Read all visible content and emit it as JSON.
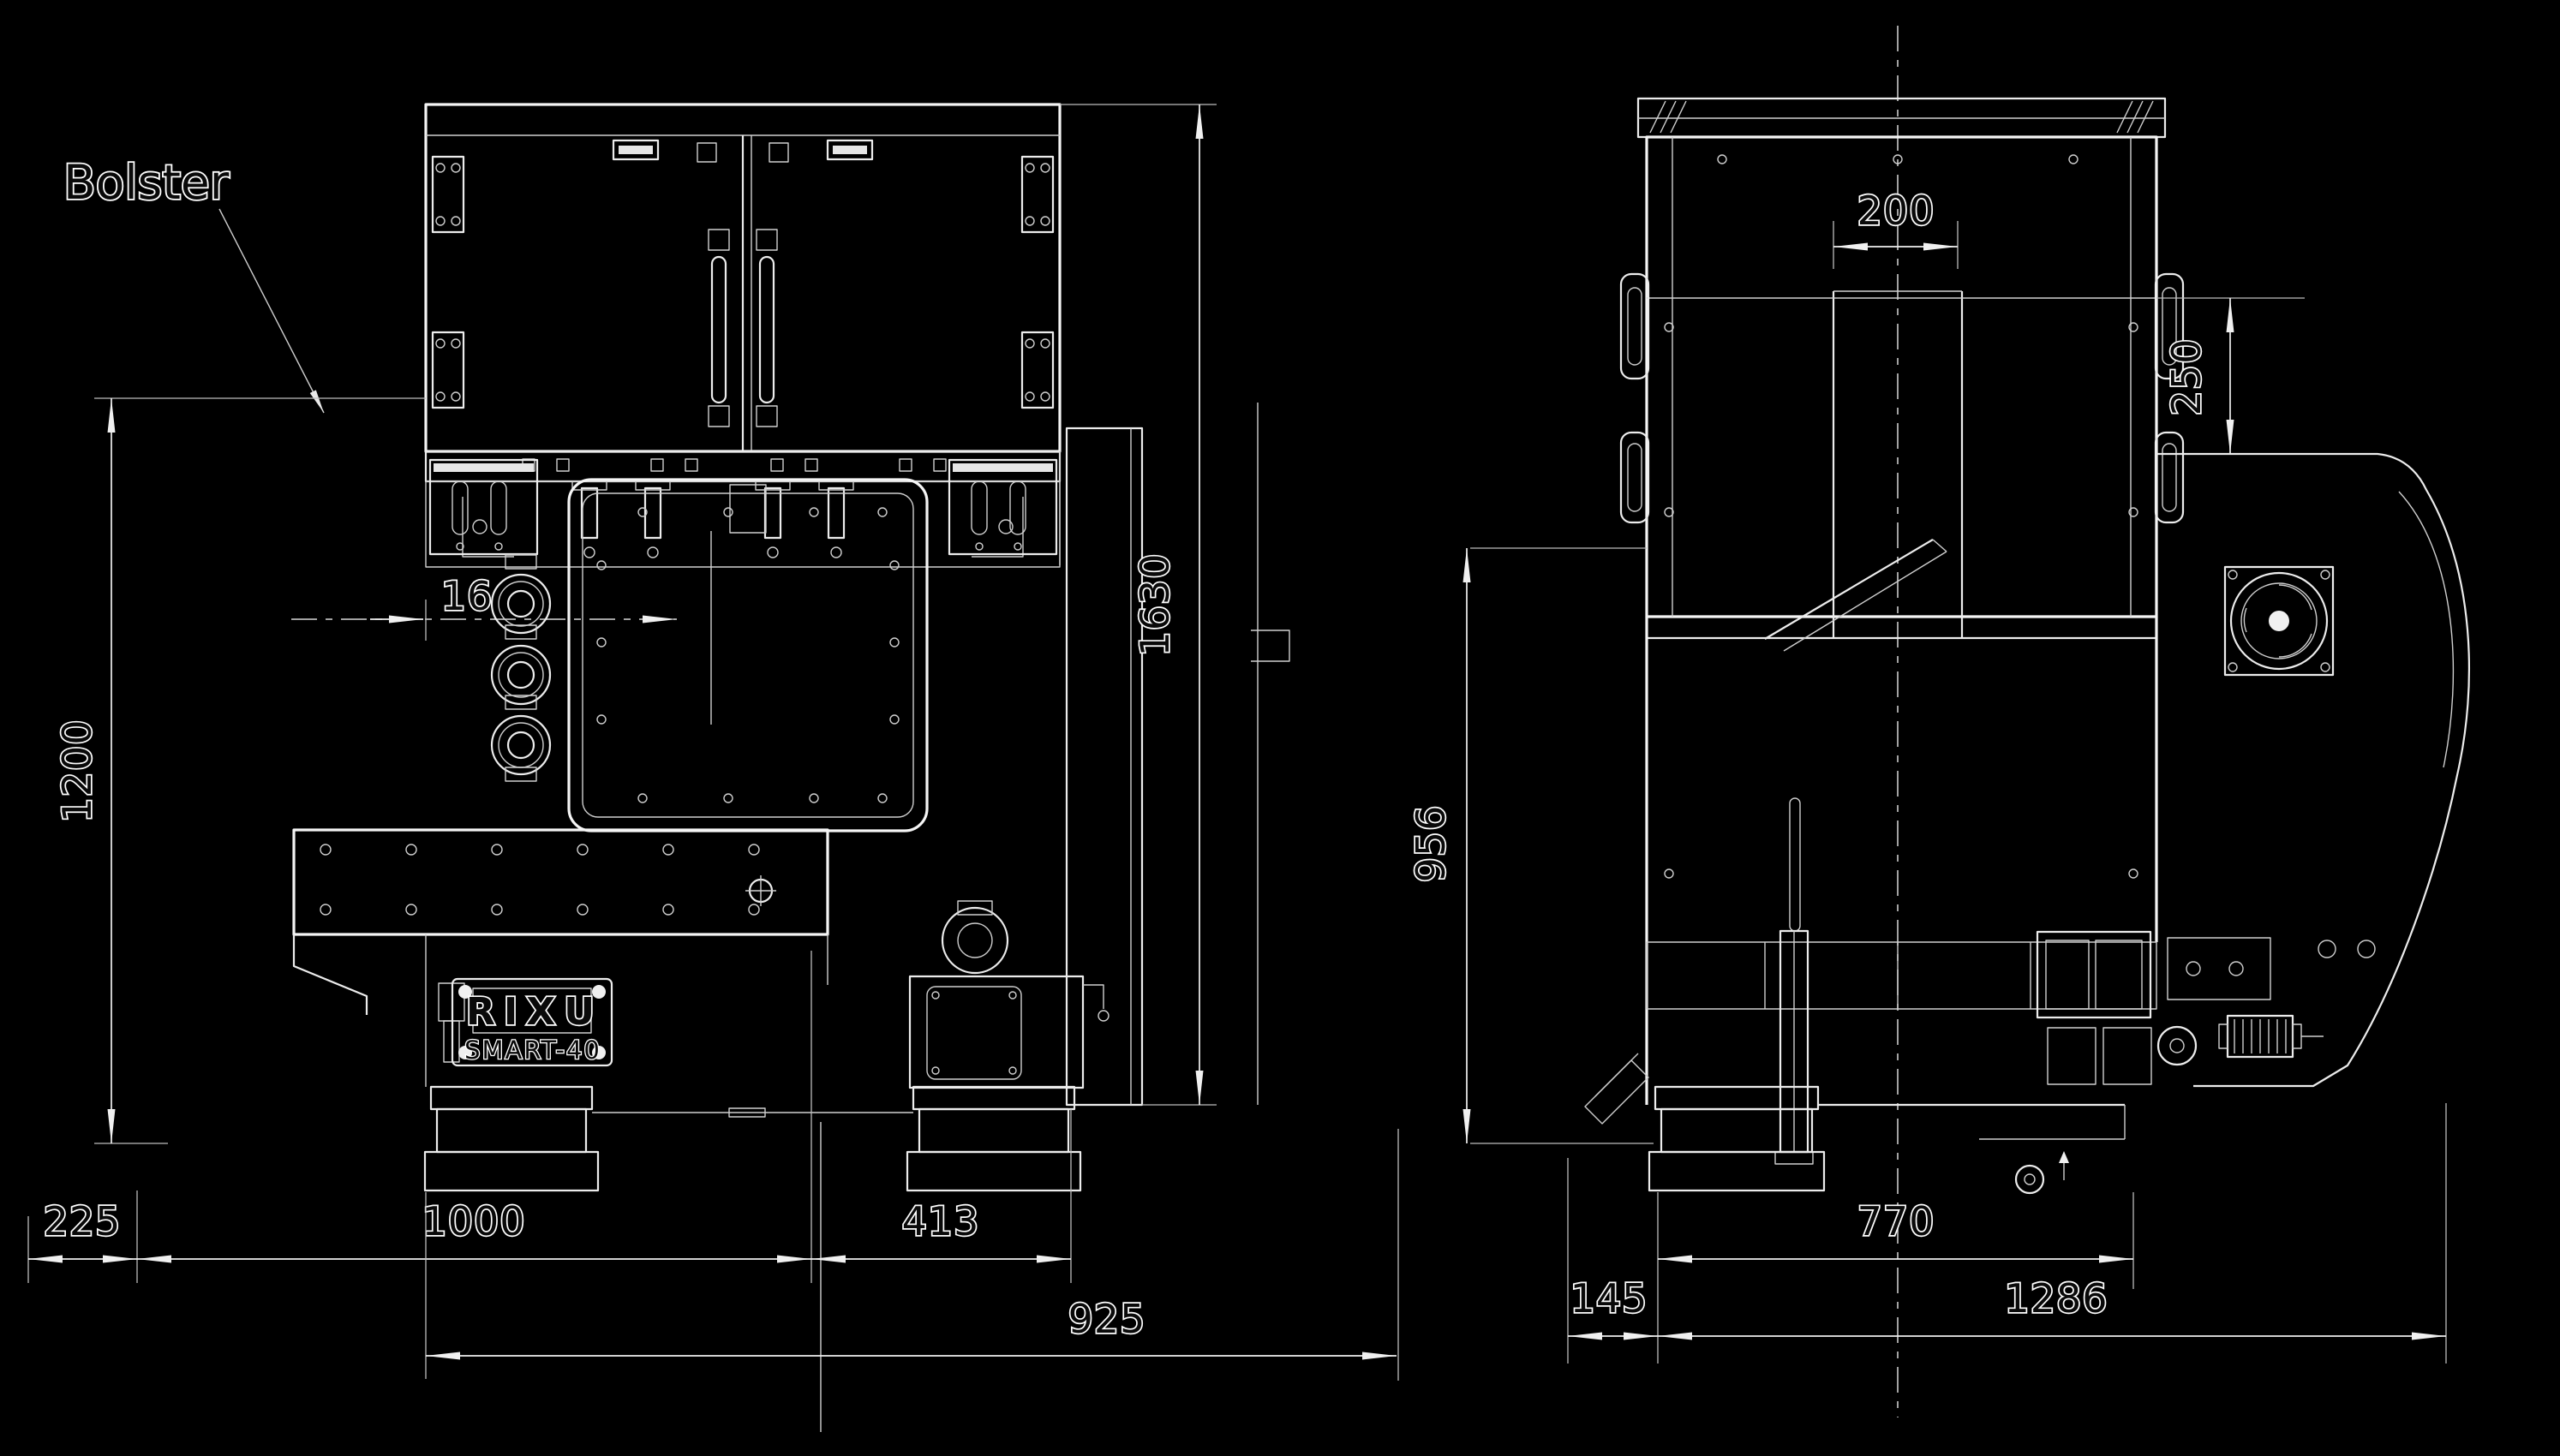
{
  "colors": {
    "background": "#000000",
    "line": "#f0f0f0",
    "text_fill": "#0a0a0a",
    "text_outline": "#ffffff"
  },
  "annotation": {
    "bolster_label": "Bolster"
  },
  "nameplate": {
    "brand": "RIXU",
    "model": "SMART-40"
  },
  "front_view": {
    "dimensions": {
      "d1200": "1200",
      "d16": "16",
      "d1630": "1630",
      "d225": "225",
      "d1000": "1000",
      "d413": "413",
      "d925": "925"
    }
  },
  "side_view": {
    "dimensions": {
      "d200": "200",
      "d250": "250",
      "d956": "956",
      "d770": "770",
      "d145": "145",
      "d1286": "1286"
    }
  }
}
